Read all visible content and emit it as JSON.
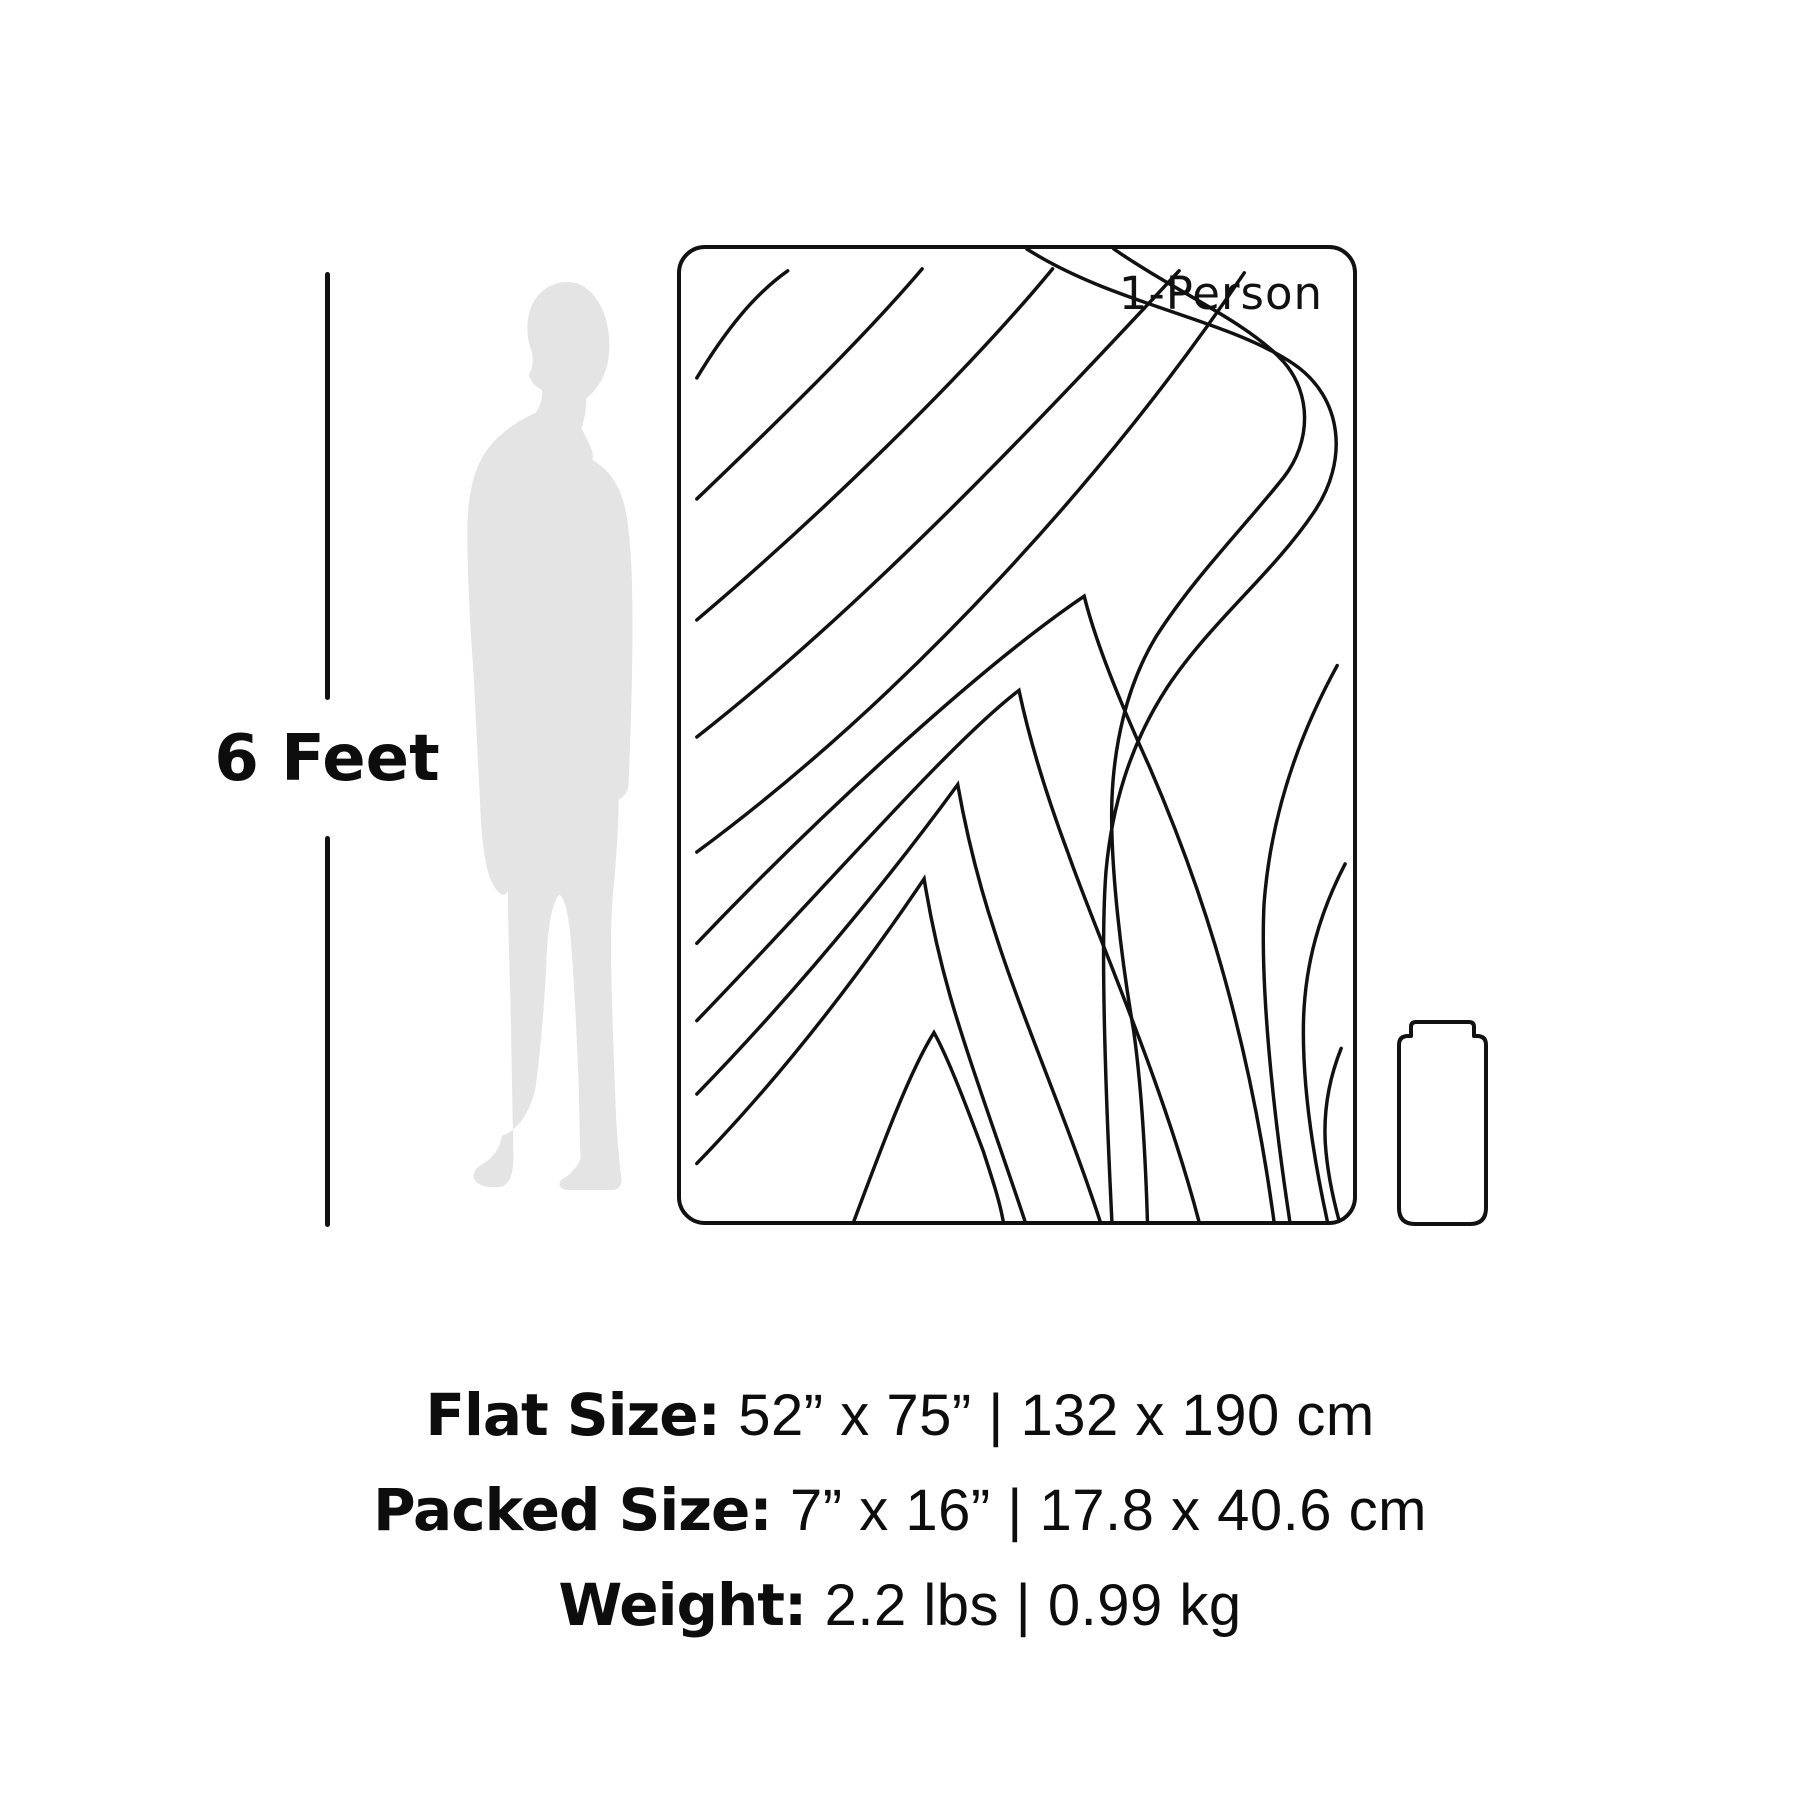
{
  "measure": {
    "label": "6 Feet"
  },
  "blanket": {
    "label": "1-Person"
  },
  "specs": [
    {
      "label": "Flat Size:",
      "value": "52” x 75” | 132 x 190 cm"
    },
    {
      "label": "Packed Size:",
      "value": "7” x 16” | 17.8 x 40.6 cm"
    },
    {
      "label": "Weight:",
      "value": "2.2 lbs | 0.99 kg"
    }
  ],
  "colors": {
    "line": "#111111",
    "silhouette": "#e4e4e4",
    "text": "#0d0d0d"
  }
}
